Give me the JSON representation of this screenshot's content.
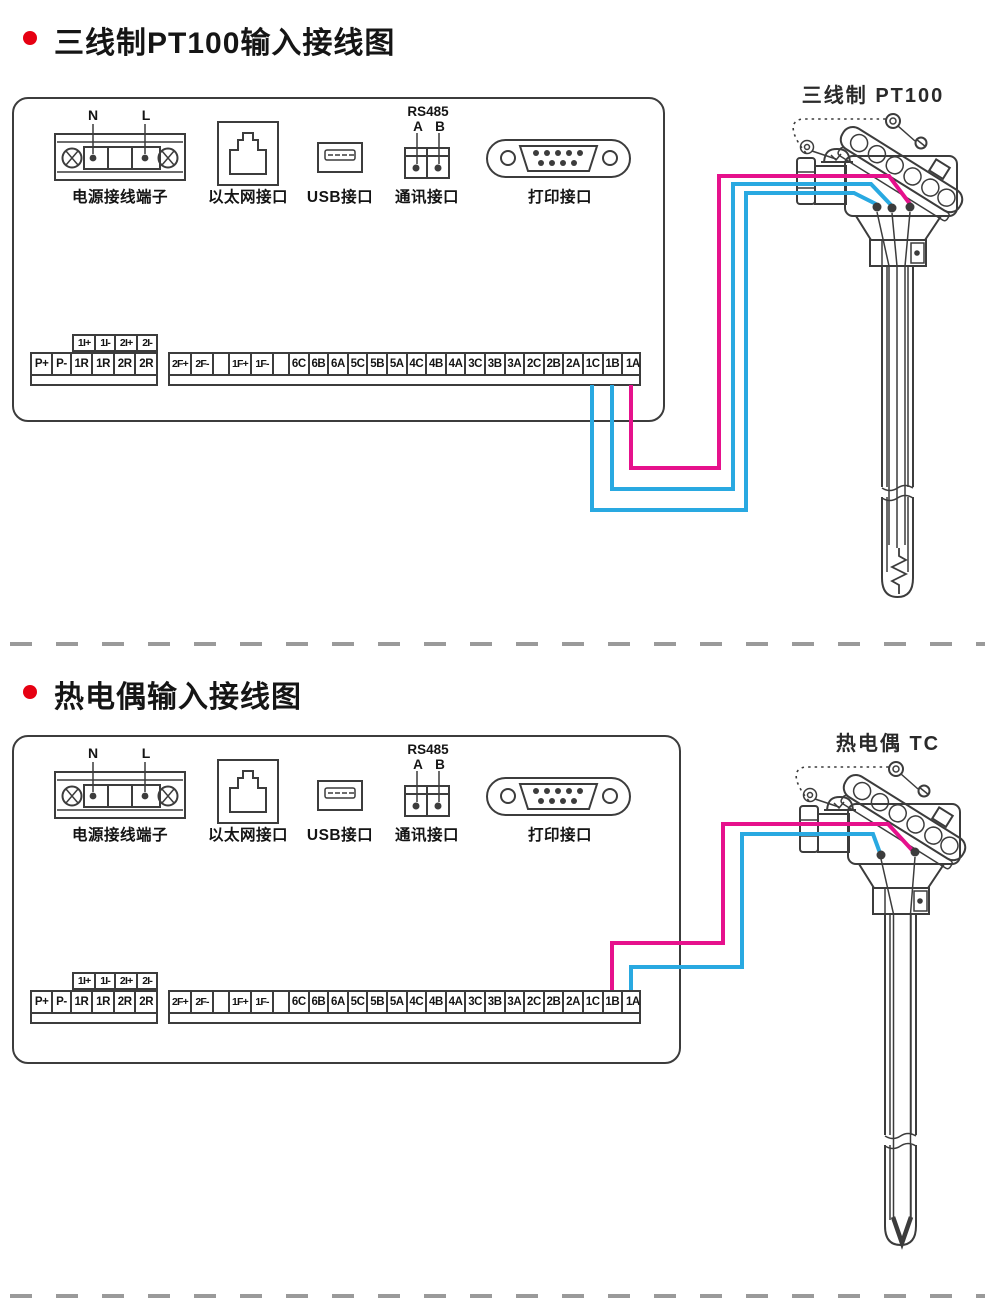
{
  "colors": {
    "wire_pink": "#e6118c",
    "wire_blue": "#29a9e1",
    "line_art": "#3c3c3c",
    "separator_gray": "#9a9a9a",
    "bullet_red": "#e60012"
  },
  "sections": [
    {
      "title": "三线制PT100输入接线图",
      "sensor_label": "三线制  PT100",
      "sensor_type": "三线制 PT100 温度传感器",
      "panel": {
        "ports": {
          "power": {
            "label": "电源接线端子",
            "pin_left": "N",
            "pin_right": "L"
          },
          "ethernet": {
            "label": "以太网接口"
          },
          "usb": {
            "label": "USB接口"
          },
          "comm": {
            "label": "通讯接口",
            "protocol": "RS485",
            "pin_a": "A",
            "pin_b": "B"
          },
          "printer": {
            "label": "打印接口"
          }
        },
        "terminals": {
          "current_strip": [
            "1I+",
            "1I-",
            "2I+",
            "2I-"
          ],
          "left_strip": [
            "P+",
            "P-",
            "1R",
            "1R",
            "2R",
            "2R"
          ],
          "right_strip": [
            "2F+",
            "2F-",
            "",
            "1F+",
            "1F-",
            "",
            "6C",
            "6B",
            "6A",
            "5C",
            "5B",
            "5A",
            "4C",
            "4B",
            "4A",
            "3C",
            "3B",
            "3A",
            "2C",
            "2B",
            "2A",
            "1C",
            "1B",
            "1A"
          ]
        }
      },
      "wiring": {
        "connections": [
          {
            "terminal": "1A",
            "wire_color": "pink"
          },
          {
            "terminal": "1B",
            "wire_color": "blue"
          },
          {
            "terminal": "1C",
            "wire_color": "blue"
          }
        ]
      }
    },
    {
      "title": "热电偶输入接线图",
      "sensor_label": "热电偶  TC",
      "sensor_type": "热电偶 TC 温度传感器",
      "panel": {
        "ports": {
          "power": {
            "label": "电源接线端子",
            "pin_left": "N",
            "pin_right": "L"
          },
          "ethernet": {
            "label": "以太网接口"
          },
          "usb": {
            "label": "USB接口"
          },
          "comm": {
            "label": "通讯接口",
            "protocol": "RS485",
            "pin_a": "A",
            "pin_b": "B"
          },
          "printer": {
            "label": "打印接口"
          }
        },
        "terminals": {
          "current_strip": [
            "1I+",
            "1I-",
            "2I+",
            "2I-"
          ],
          "left_strip": [
            "P+",
            "P-",
            "1R",
            "1R",
            "2R",
            "2R"
          ],
          "right_strip": [
            "2F+",
            "2F-",
            "",
            "1F+",
            "1F-",
            "",
            "6C",
            "6B",
            "6A",
            "5C",
            "5B",
            "5A",
            "4C",
            "4B",
            "4A",
            "3C",
            "3B",
            "3A",
            "2C",
            "2B",
            "2A",
            "1C",
            "1B",
            "1A"
          ]
        }
      },
      "wiring": {
        "connections": [
          {
            "terminal": "1B",
            "wire_color": "pink"
          },
          {
            "terminal": "1A",
            "wire_color": "blue"
          }
        ]
      }
    }
  ]
}
